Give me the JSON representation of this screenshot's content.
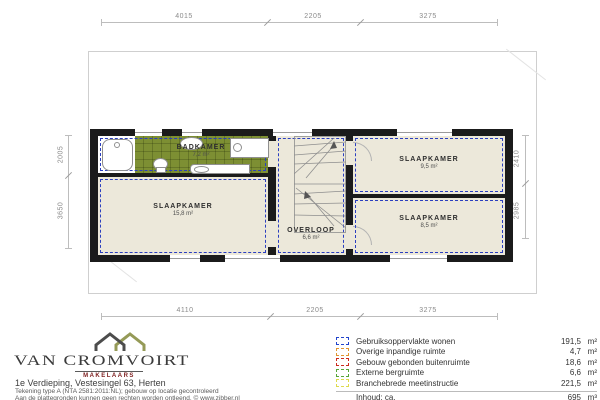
{
  "plan": {
    "rooms": [
      {
        "name": "BADKAMER",
        "area": "7,2 m²"
      },
      {
        "name": "SLAAPKAMER",
        "area": "15,8 m²"
      },
      {
        "name": "OVERLOOP",
        "area": "6,6 m²"
      },
      {
        "name": "SLAAPKAMER",
        "area": "9,5 m²"
      },
      {
        "name": "SLAAPKAMER",
        "area": "8,5 m²"
      }
    ],
    "colors": {
      "wall": "#1b1b1b",
      "floor": "#ece8da",
      "bathroom_tiles": "#7d8f33",
      "measurement_line": "#2b3fbf"
    }
  },
  "dimensions": {
    "top": [
      "4015",
      "2205",
      "3275"
    ],
    "bottom": [
      "4110",
      "2205",
      "3275"
    ],
    "left": [
      "2005",
      "3650"
    ],
    "right": [
      "2410",
      "2985"
    ]
  },
  "legend": {
    "rows": [
      {
        "label": "Gebruiksoppervlakte wonen",
        "value": "191,5",
        "unit": "m²",
        "color": "#2244cc"
      },
      {
        "label": "Overige inpandige ruimte",
        "value": "4,7",
        "unit": "m²",
        "color": "#e0952f"
      },
      {
        "label": "Gebouw gebonden buitenruimte",
        "value": "18,6",
        "unit": "m²",
        "color": "#cc2a1e"
      },
      {
        "label": "Externe bergruimte",
        "value": "6,6",
        "unit": "m²",
        "color": "#57a639"
      },
      {
        "label": "Branchebrede meetinstructie",
        "value": "221,5",
        "unit": "m²",
        "color": "#dedb4e"
      }
    ],
    "volume": {
      "label": "Inhoud: ca.",
      "value": "695",
      "unit": "m³"
    }
  },
  "branding": {
    "company": "VAN CROMVOIRT",
    "tagline": "MAKELAARS",
    "address": "1e Verdieping, Vestesingel 63, Herten",
    "fine_print_1": "Tekening type A (NTA 2581:2011:NL); gebouw op locatie gecontroleerd",
    "fine_print_2": "Aan de plattegronden kunnen geen rechten worden ontleend. © www.zibber.nl"
  }
}
